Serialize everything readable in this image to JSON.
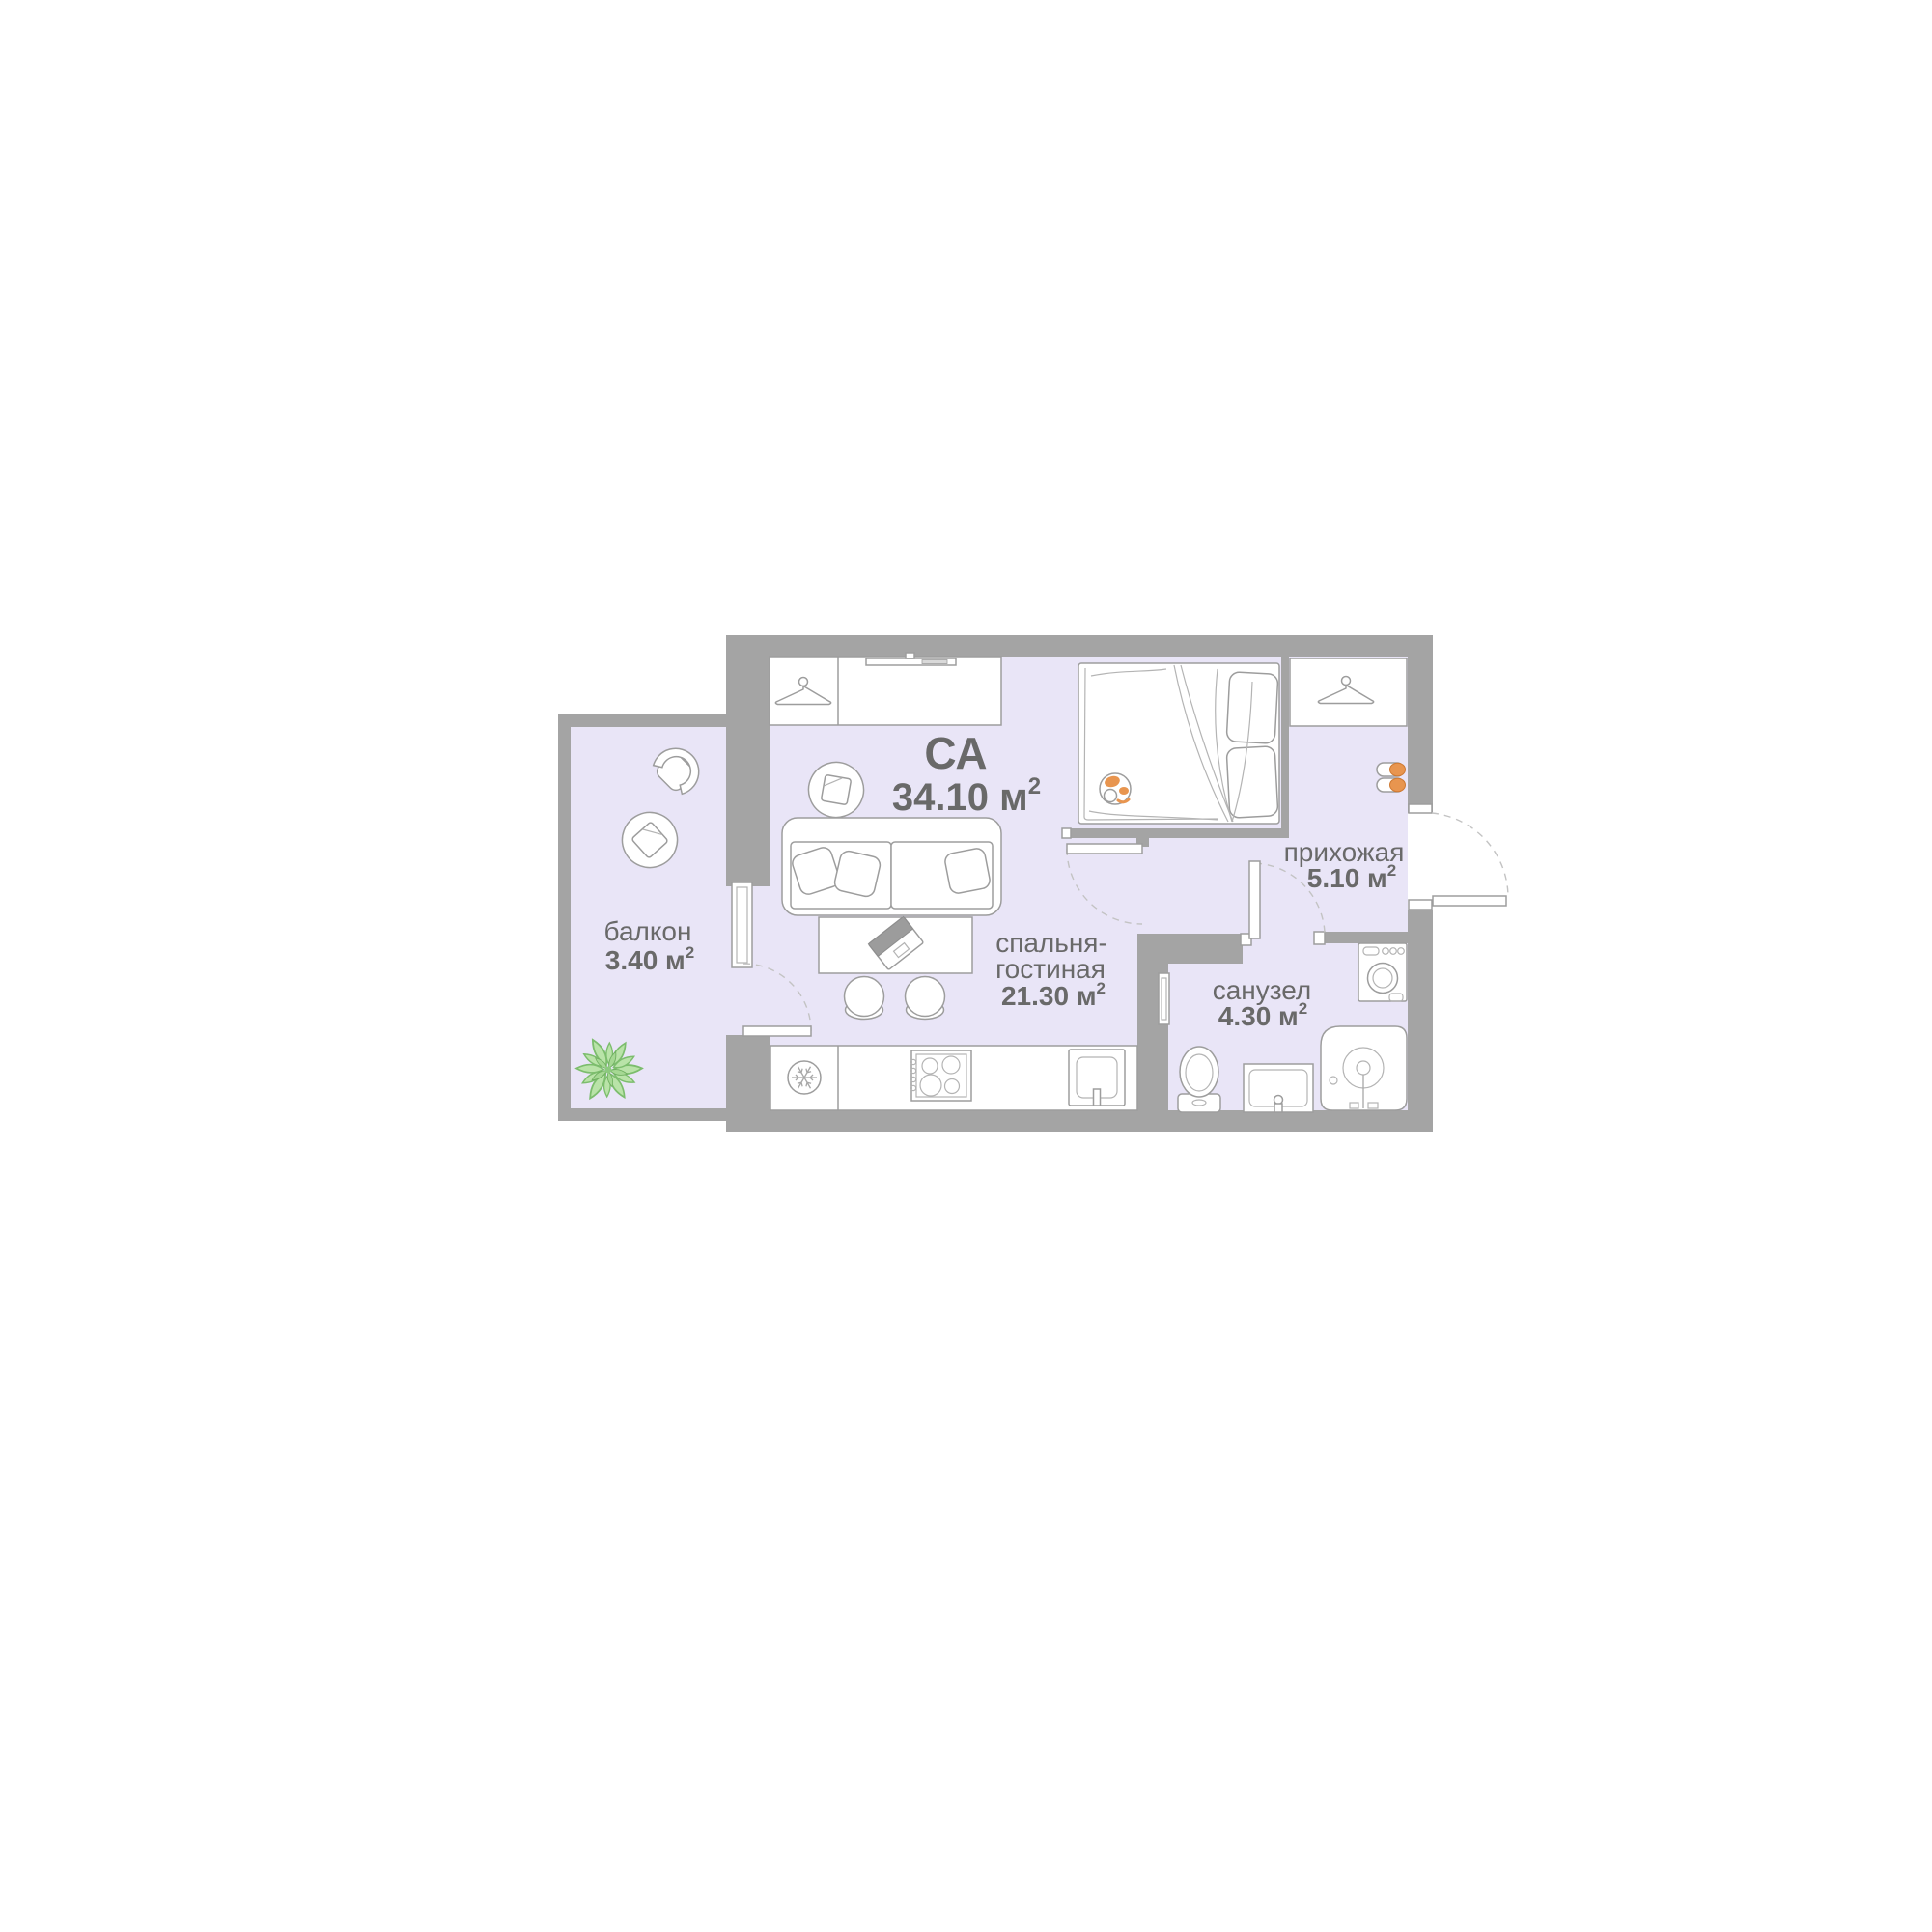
{
  "plan_title": {
    "code": "СА",
    "area": "34.10 м",
    "area_sup": "2"
  },
  "rooms": {
    "living": {
      "name_line1": "спальня-",
      "name_line2": "гостиная",
      "area": "21.30 м",
      "area_sup": "2"
    },
    "balcony": {
      "name": "балкон",
      "area": "3.40 м",
      "area_sup": "2"
    },
    "hallway": {
      "name": "прихожая",
      "area": "5.10 м",
      "area_sup": "2"
    },
    "bathroom": {
      "name": "санузел",
      "area": "4.30 м",
      "area_sup": "2"
    }
  },
  "colors": {
    "wall_gray": "#a4a4a4",
    "room_fill": "#e9e5f7",
    "outline_gray": "#9d9d9d",
    "text_gray": "#696969",
    "accent_orange": "#e8954f",
    "plant_green": "#b9e3a8"
  },
  "icons": [
    "hanger-icon",
    "tv-icon",
    "snowflake-icon",
    "slippers-icon",
    "cat-icon",
    "plant-icon",
    "laptop-icon",
    "door-swing-arc",
    "window",
    "shower",
    "toilet",
    "bathroom-sink",
    "kitchen-sink",
    "stove",
    "washing-machine-icon"
  ]
}
